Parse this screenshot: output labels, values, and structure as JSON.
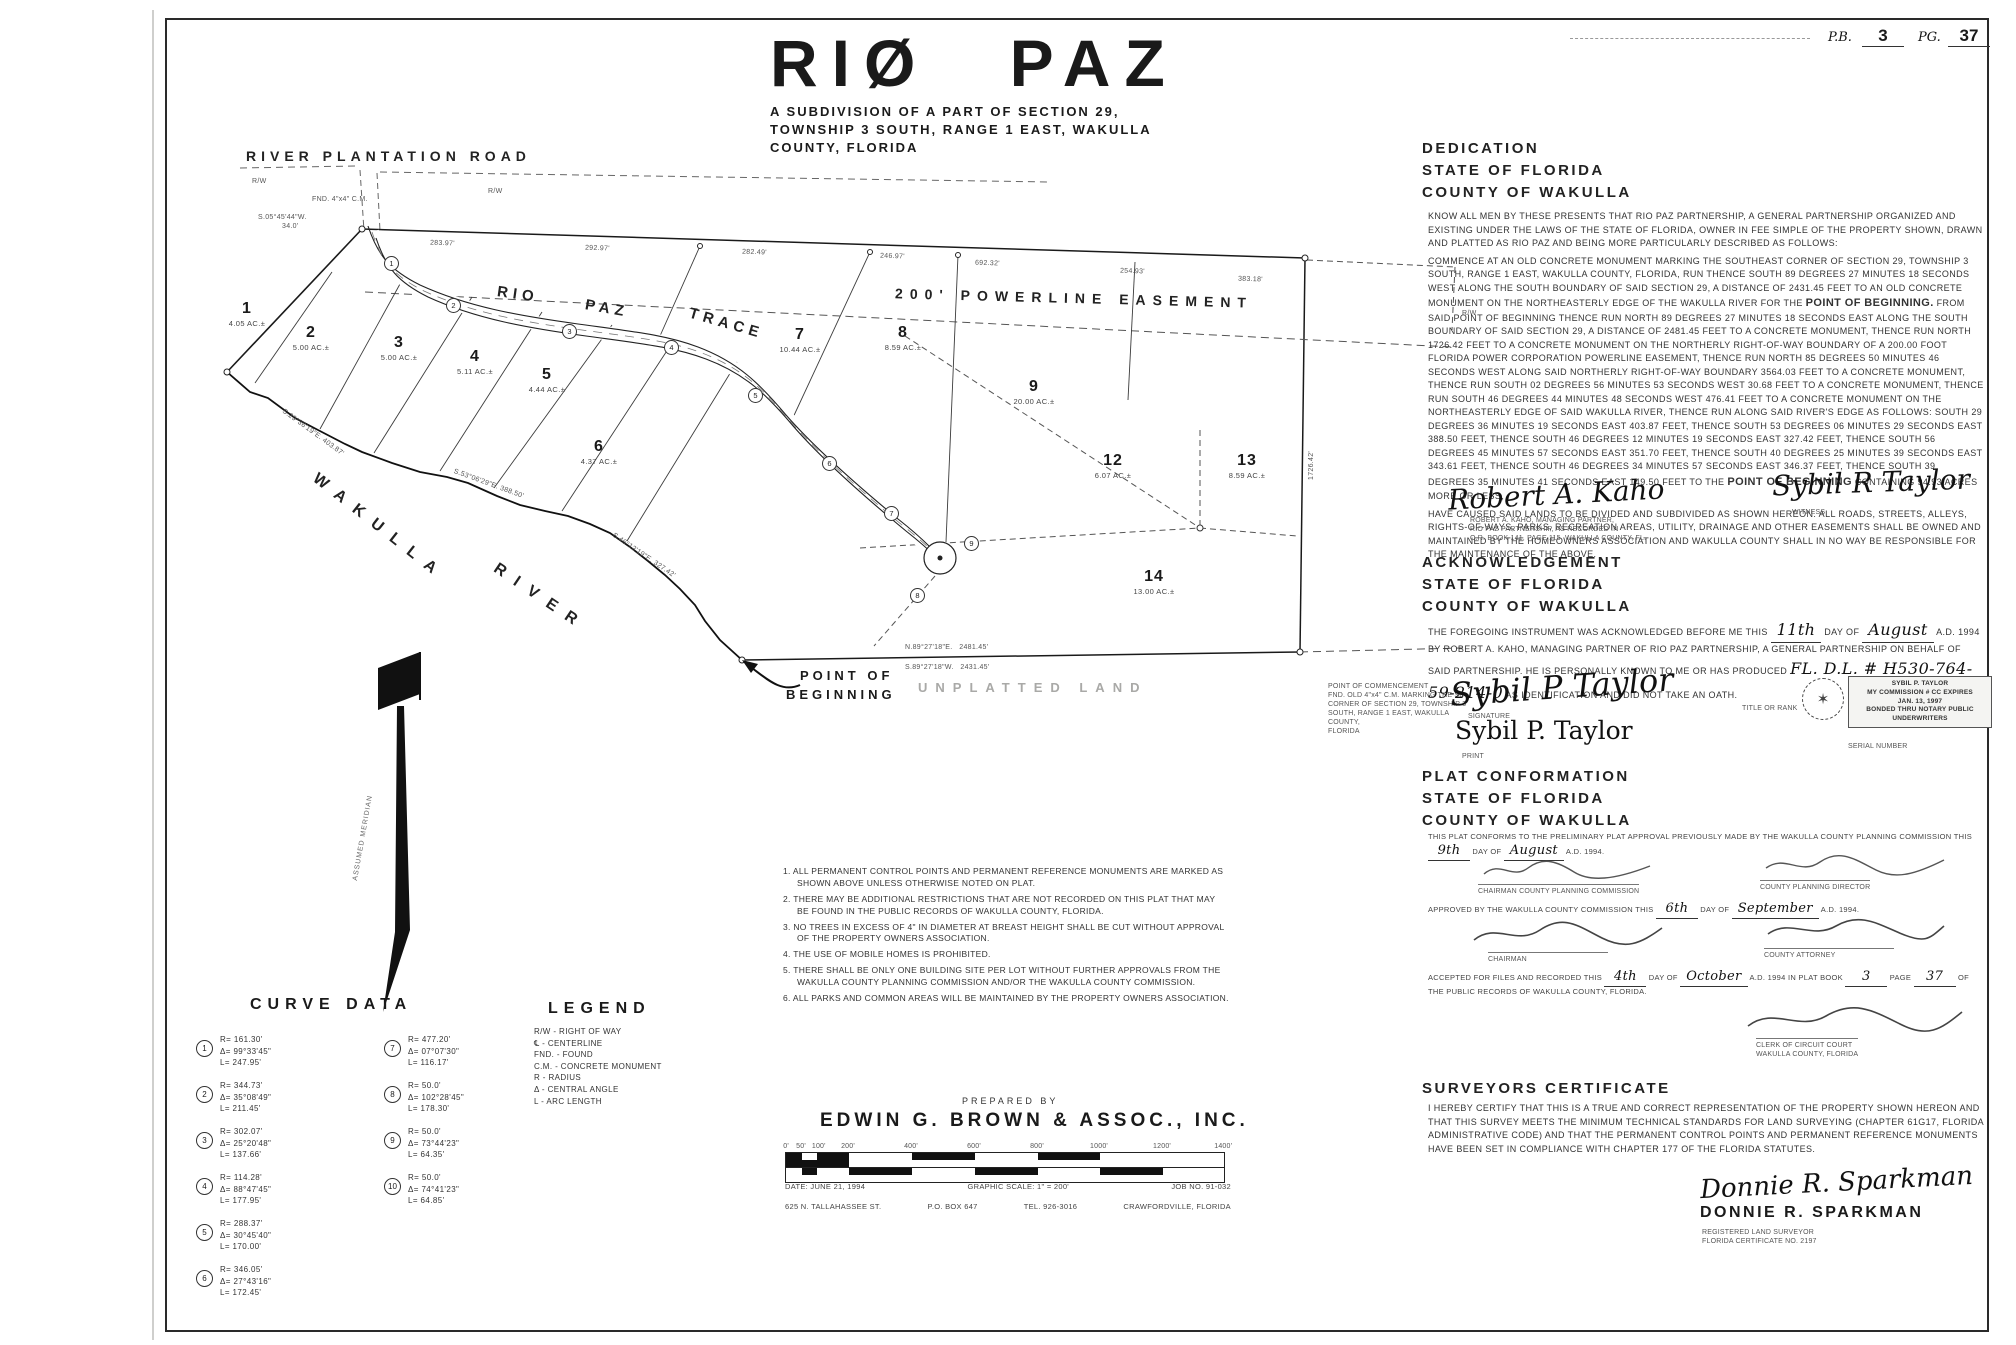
{
  "page": {
    "pb_label": "P.B.",
    "pb_value": "3",
    "pg_label": "PG.",
    "pg_value": "37"
  },
  "title": {
    "main": "RIØ PAZ",
    "sub1": "A SUBDIVISION OF A PART OF SECTION 29,",
    "sub2": "TOWNSHIP 3 SOUTH, RANGE 1 EAST, WAKULLA",
    "sub3": "COUNTY, FLORIDA"
  },
  "map": {
    "road_label": "RIVER PLANTATION ROAD",
    "trace_1": "RIO",
    "trace_2": "PAZ",
    "trace_3": "TRACE",
    "easement_label": "200' POWERLINE EASEMENT",
    "river_1": "WAKULLA",
    "river_2": "RIVER",
    "pob_1": "POINT OF",
    "pob_2": "BEGINNING",
    "unplatted": "UNPLATTED LAND",
    "meridian": "ASSUMED MERIDIAN",
    "rw_1": "R/W",
    "rw_2": "R/W",
    "rw_3": "R/W",
    "corner_note": "FND. 4\"x4\" C.M.",
    "corner_bearing": "S.05°45'44\"W.",
    "corner_dist": "34.0'",
    "bottom_bearing_n": "N.89°27'18\"E.",
    "bottom_dist_n": "2481.45'",
    "bottom_bearing_s": "S.89°27'18\"W.",
    "bottom_dist_s": "2431.45'",
    "right_dim": "1726.42'",
    "top_dims": [
      "283.97'",
      "292.97'",
      "282.49'",
      "246.97'",
      "692.32'",
      "254.93'",
      "383.18'"
    ],
    "river_dims": [
      "S.29°36'19\"E. 403.87'",
      "S.53°06'29\"E. 388.50'",
      "S.46°12'19\"E. 327.42'"
    ],
    "poc_note": [
      "POINT OF COMMENCEMENT",
      "FND. OLD 4\"x4\" C.M. MARKING THE SE",
      "CORNER OF SECTION 29, TOWNSHIP 3",
      "SOUTH, RANGE 1 EAST, WAKULLA COUNTY,",
      "FLORIDA"
    ],
    "lots": [
      {
        "n": "1",
        "ac": "4.05 AC.±"
      },
      {
        "n": "2",
        "ac": "5.00 AC.±"
      },
      {
        "n": "3",
        "ac": "5.00 AC.±"
      },
      {
        "n": "4",
        "ac": "5.11 AC.±"
      },
      {
        "n": "5",
        "ac": "4.44 AC.±"
      },
      {
        "n": "6",
        "ac": "4.37 AC.±"
      },
      {
        "n": "7",
        "ac": "10.44 AC.±"
      },
      {
        "n": "8",
        "ac": "8.59 AC.±"
      },
      {
        "n": "9",
        "ac": "20.00 AC.±"
      },
      {
        "n": "12",
        "ac": "6.07 AC.±"
      },
      {
        "n": "13",
        "ac": "8.59 AC.±"
      },
      {
        "n": "14",
        "ac": "13.00 AC.±"
      }
    ]
  },
  "dedication": {
    "h1": "DEDICATION",
    "h2": "STATE OF FLORIDA",
    "h3": "COUNTY OF WAKULLA",
    "para1": "KNOW ALL MEN BY THESE PRESENTS THAT RIO PAZ PARTNERSHIP, A GENERAL PARTNERSHIP ORGANIZED AND EXISTING UNDER THE LAWS OF THE STATE OF FLORIDA, OWNER IN FEE SIMPLE OF THE PROPERTY SHOWN, DRAWN AND PLATTED AS RIO PAZ AND BEING MORE PARTICULARLY DESCRIBED AS FOLLOWS:",
    "para2a": "COMMENCE AT AN OLD CONCRETE MONUMENT MARKING THE SOUTHEAST CORNER OF SECTION 29, TOWNSHIP 3 SOUTH, RANGE 1 EAST, WAKULLA COUNTY, FLORIDA, RUN THENCE SOUTH 89 DEGREES 27 MINUTES 18 SECONDS WEST ALONG THE SOUTH BOUNDARY OF SAID SECTION 29, A DISTANCE OF 2431.45 FEET TO AN OLD CONCRETE MONUMENT ON THE NORTHEASTERLY EDGE OF THE WAKULLA RIVER FOR THE ",
    "pob1": "POINT OF BEGINNING.",
    "para2b": " FROM SAID POINT OF BEGINNING THENCE RUN NORTH 89 DEGREES 27 MINUTES 18 SECONDS EAST ALONG THE SOUTH BOUNDARY OF SAID SECTION 29, A DISTANCE OF 2481.45 FEET TO A CONCRETE MONUMENT, THENCE RUN NORTH 1726.42 FEET TO A CONCRETE MONUMENT ON THE NORTHERLY RIGHT-OF-WAY BOUNDARY OF A 200.00 FOOT FLORIDA POWER CORPORATION POWERLINE EASEMENT, THENCE RUN NORTH 85 DEGREES 50 MINUTES 46 SECONDS WEST ALONG SAID NORTHERLY RIGHT-OF-WAY BOUNDARY 3564.03 FEET TO A CONCRETE MONUMENT, THENCE RUN SOUTH 02 DEGREES 56 MINUTES 53 SECONDS WEST 30.68 FEET TO A CONCRETE MONUMENT, THENCE RUN SOUTH 46 DEGREES 44 MINUTES 48 SECONDS WEST 476.41 FEET TO A CONCRETE MONUMENT ON THE NORTHEASTERLY EDGE OF SAID WAKULLA RIVER, THENCE RUN ALONG SAID RIVER'S EDGE AS FOLLOWS: SOUTH 29 DEGREES 36 MINUTES 19 SECONDS EAST 403.87 FEET, THENCE SOUTH 53 DEGREES 06 MINUTES 29 SECONDS EAST 388.50 FEET, THENCE SOUTH 46 DEGREES 12 MINUTES 19 SECONDS EAST 327.42 FEET, THENCE SOUTH 56 DEGREES 45 MINUTES 57 SECONDS EAST 351.70 FEET, THENCE SOUTH 40 DEGREES 25 MINUTES 39 SECONDS EAST 343.61 FEET, THENCE SOUTH 46 DEGREES 34 MINUTES 57 SECONDS EAST 346.37 FEET, THENCE SOUTH 39 DEGREES 35 MINUTES 41 SECONDS EAST 149.50 FEET TO THE ",
    "pob2": "POINT OF BEGINNING",
    "para2c": " CONTAINING 94.93 ACRES MORE OR LESS,",
    "para3": "HAVE CAUSED SAID LANDS TO BE DIVIDED AND SUBDIVIDED AS SHOWN HEREON. ALL ROADS, STREETS, ALLEYS, RIGHTS-OF-WAYS, PARKS, RECREATION AREAS, UTILITY, DRAINAGE AND OTHER EASEMENTS SHALL BE OWNED AND MAINTAINED BY THE HOMEOWNERS ASSOCIATION AND WAKULLA COUNTY SHALL IN NO WAY BE RESPONSIBLE FOR THE MAINTENANCE OF THE ABOVE.",
    "sig1_name": "Robert A. Kaho",
    "sig1_cap1": "ROBERT A. KAHO, MANAGING PARTNER,",
    "sig1_cap2": "RIO PAZ PARTNERSHIP, AS RECORDED IN",
    "sig1_cap3": "O.R. BOOK 141, PAGE 115, WAKULLA COUNTY, FL.",
    "sig2_name": "Sybil R Taylor",
    "sig2_cap": "WITNESS"
  },
  "acknowledgement": {
    "h1": "ACKNOWLEDGEMENT",
    "h2": "STATE OF FLORIDA",
    "h3": "COUNTY OF WAKULLA",
    "b1": "THE FOREGOING INSTRUMENT WAS ACKNOWLEDGED BEFORE ME THIS ",
    "day": "11th",
    "b2": " DAY OF ",
    "month": "August",
    "b3": " A.D. 1994 BY ROBERT A. KAHO, MANAGING PARTNER OF RIO PAZ PARTNERSHIP, A GENERAL PARTNERSHIP ON BEHALF OF SAID PARTNERSHIP. HE IS PERSONALLY KNOWN TO ME OR HAS PRODUCED ",
    "dl": "FL. D.L. # H530-764-59-214-0",
    "b4": " AS IDENTIFICATION AND DID NOT TAKE AN OATH.",
    "sig_name": "Sybil P Taylor",
    "sig_cap": "SIGNATURE",
    "print_name": "Sybil P. Taylor",
    "print_cap": "PRINT",
    "title_cap": "TITLE OR RANK",
    "serial_cap": "SERIAL NUMBER",
    "stamp": [
      "SYBIL P. TAYLOR",
      "MY COMMISSION # CC EXPIRES",
      "JAN. 13, 1997",
      "BONDED THRU NOTARY PUBLIC UNDERWRITERS"
    ]
  },
  "conformation": {
    "h1": "PLAT CONFORMATION",
    "h2": "STATE OF FLORIDA",
    "h3": "COUNTY OF WAKULLA",
    "b1a": "THIS PLAT CONFORMS TO THE PRELIMINARY PLAT APPROVAL PREVIOUSLY MADE BY THE WAKULLA COUNTY PLANNING COMMISSION THIS ",
    "day1": "9th",
    "b1b": " DAY OF ",
    "month1": "August",
    "b1c": " A.D. 1994.",
    "cap1a": "CHAIRMAN COUNTY PLANNING COMMISSION",
    "cap1b": "COUNTY PLANNING DIRECTOR",
    "b2a": "APPROVED BY THE WAKULLA COUNTY COMMISSION THIS ",
    "day2": "6th",
    "b2b": " DAY OF ",
    "month2": "September",
    "b2c": " A.D. 1994.",
    "cap2a": "CHAIRMAN",
    "cap2b": "COUNTY ATTORNEY",
    "b3a": "ACCEPTED FOR FILES AND RECORDED THIS ",
    "day3": "4th",
    "b3b": " DAY OF ",
    "month3": "October",
    "b3c": " A.D. 1994 IN PLAT BOOK ",
    "book": "3",
    "b3d": " PAGE ",
    "pg": "37",
    "b3e": " OF THE PUBLIC RECORDS OF WAKULLA COUNTY, FLORIDA.",
    "cap3a": "CLERK OF CIRCUIT COURT",
    "cap3b": "WAKULLA COUNTY, FLORIDA"
  },
  "certificate": {
    "h1": "SURVEYORS CERTIFICATE",
    "body": "I HEREBY CERTIFY THAT THIS IS A TRUE AND CORRECT REPRESENTATION OF THE PROPERTY SHOWN HEREON AND THAT THIS SURVEY MEETS THE MINIMUM TECHNICAL STANDARDS FOR LAND SURVEYING (CHAPTER 61G17, FLORIDA ADMINISTRATIVE CODE) AND THAT THE PERMANENT CONTROL POINTS AND PERMANENT REFERENCE MONUMENTS HAVE BEEN SET IN COMPLIANCE WITH CHAPTER 177 OF THE FLORIDA STATUTES.",
    "sig_name": "Donnie R. Sparkman",
    "name": "DONNIE R. SPARKMAN",
    "cap1": "REGISTERED LAND SURVEYOR",
    "cap2": "FLORIDA CERTIFICATE NO. 2197"
  },
  "curve_data": {
    "title": "CURVE DATA",
    "curves": [
      {
        "n": "1",
        "r": "R= 161.30'",
        "d": "Δ= 99°33'45\"",
        "l": "L= 247.95'"
      },
      {
        "n": "2",
        "r": "R= 344.73'",
        "d": "Δ= 35°08'49\"",
        "l": "L= 211.45'"
      },
      {
        "n": "3",
        "r": "R= 302.07'",
        "d": "Δ= 25°20'48\"",
        "l": "L= 137.66'"
      },
      {
        "n": "4",
        "r": "R= 114.28'",
        "d": "Δ= 88°47'45\"",
        "l": "L= 177.95'"
      },
      {
        "n": "5",
        "r": "R= 288.37'",
        "d": "Δ= 30°45'40\"",
        "l": "L= 170.00'"
      },
      {
        "n": "6",
        "r": "R= 346.05'",
        "d": "Δ= 27°43'16\"",
        "l": "L= 172.45'"
      },
      {
        "n": "7",
        "r": "R= 477.20'",
        "d": "Δ= 07°07'30\"",
        "l": "L= 116.17'"
      },
      {
        "n": "8",
        "r": "R= 50.0'",
        "d": "Δ= 102°28'45\"",
        "l": "L= 178.30'"
      },
      {
        "n": "9",
        "r": "R= 50.0'",
        "d": "Δ= 73°44'23\"",
        "l": "L= 64.35'"
      },
      {
        "n": "10",
        "r": "R= 50.0'",
        "d": "Δ= 74°41'23\"",
        "l": "L= 64.85'"
      }
    ]
  },
  "legend": {
    "title": "LEGEND",
    "items": [
      "R/W - RIGHT OF WAY",
      "℄ - CENTERLINE",
      "FND. - FOUND",
      "C.M. - CONCRETE MONUMENT",
      "R - RADIUS",
      "Δ - CENTRAL ANGLE",
      "L - ARC LENGTH"
    ]
  },
  "notes": [
    "1. ALL PERMANENT CONTROL POINTS AND PERMANENT REFERENCE MONUMENTS ARE MARKED AS SHOWN ABOVE UNLESS OTHERWISE NOTED ON PLAT.",
    "2. THERE MAY BE ADDITIONAL RESTRICTIONS THAT ARE NOT RECORDED ON THIS PLAT THAT MAY BE FOUND IN THE PUBLIC RECORDS OF WAKULLA COUNTY, FLORIDA.",
    "3. NO TREES IN EXCESS OF 4\" IN DIAMETER AT BREAST HEIGHT SHALL BE CUT WITHOUT APPROVAL OF THE PROPERTY OWNERS ASSOCIATION.",
    "4. THE USE OF MOBILE HOMES IS PROHIBITED.",
    "5. THERE SHALL BE ONLY ONE BUILDING SITE PER LOT WITHOUT FURTHER APPROVALS FROM THE WAKULLA COUNTY PLANNING COMMISSION AND/OR THE WAKULLA COUNTY COMMISSION.",
    "6. ALL PARKS AND COMMON AREAS WILL BE MAINTAINED BY THE PROPERTY OWNERS ASSOCIATION."
  ],
  "prepared": {
    "by": "PREPARED BY",
    "firm": "EDWIN G. BROWN & ASSOC., INC.",
    "date": "DATE: JUNE 21, 1994",
    "scale": "GRAPHIC SCALE: 1\" = 200'",
    "job": "JOB NO. 91-032",
    "addr1": "625 N. TALLAHASSEE ST.",
    "addr2": "P.O. BOX 647",
    "addr3": "TEL. 926-3016",
    "addr4": "CRAWFORDVILLE, FLORIDA",
    "scale_labels": [
      "0'",
      "50'",
      "100'",
      "200'",
      "400'",
      "600'",
      "800'",
      "1000'",
      "1200'",
      "1400'"
    ]
  }
}
